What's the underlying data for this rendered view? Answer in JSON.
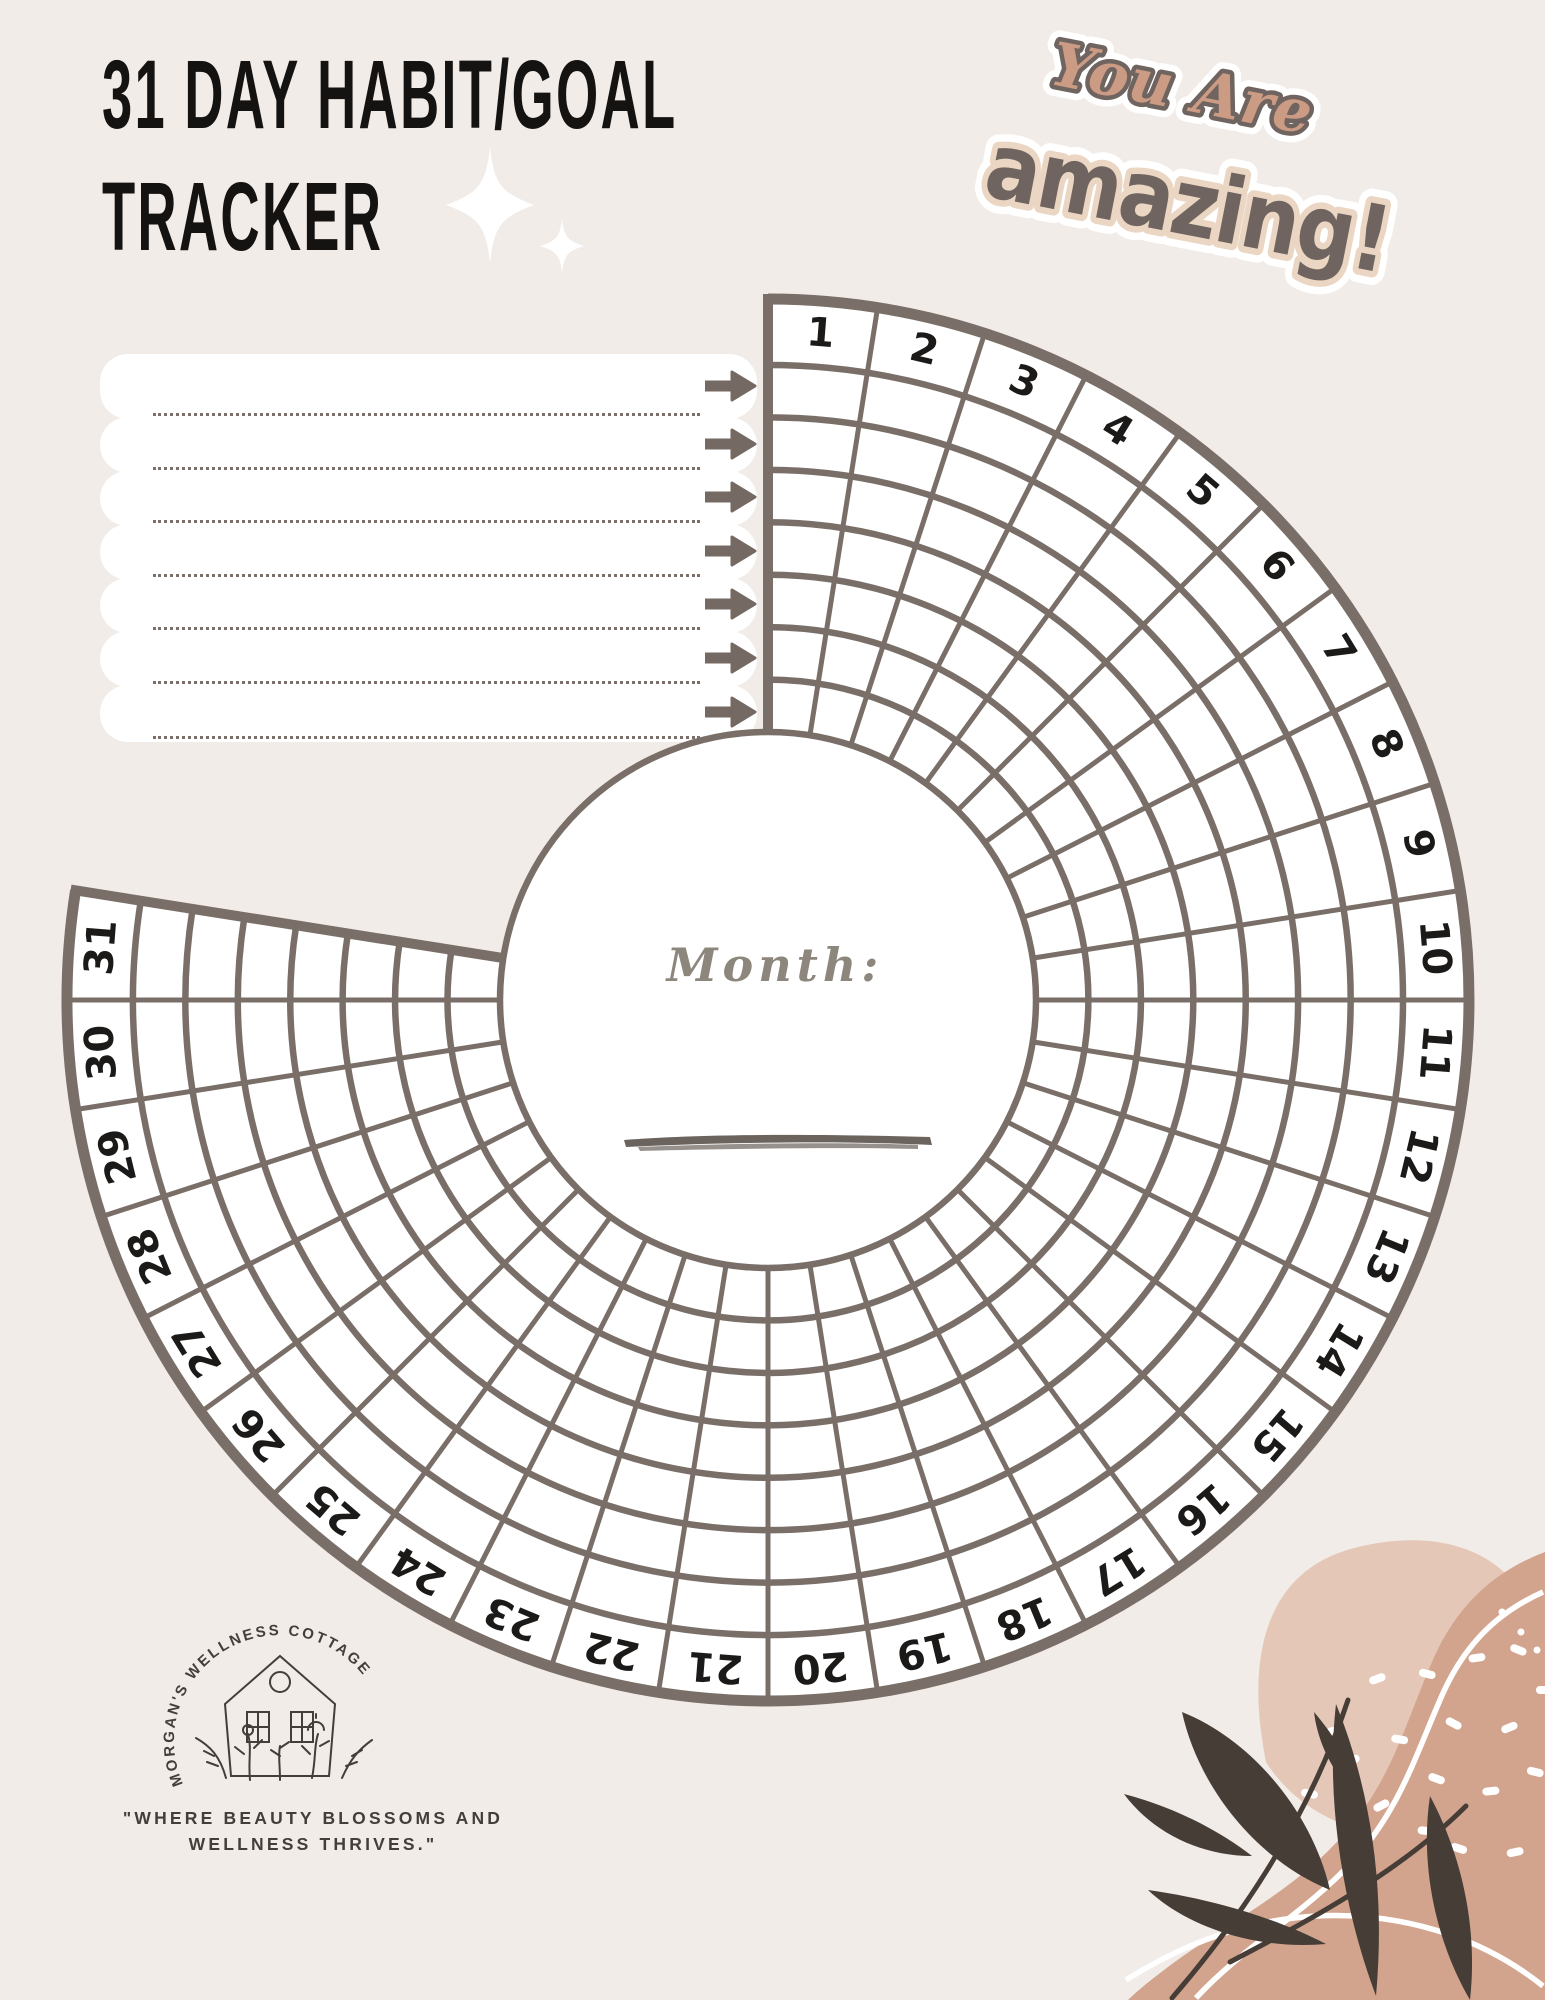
{
  "page": {
    "title_line1": "31 DAY HABIT/GOAL",
    "title_line2": "TRACKER"
  },
  "sticker": {
    "line1": "You Are",
    "line2": "amazing!"
  },
  "habit_box": {
    "lines": [
      "",
      "",
      "",
      "",
      "",
      "",
      ""
    ]
  },
  "tracker": {
    "month_label": "Month:",
    "month_value": "",
    "rings_per_day": 7,
    "days": [
      "1",
      "2",
      "3",
      "4",
      "5",
      "6",
      "7",
      "8",
      "9",
      "10",
      "11",
      "12",
      "13",
      "14",
      "15",
      "16",
      "17",
      "18",
      "19",
      "20",
      "21",
      "22",
      "23",
      "24",
      "25",
      "26",
      "27",
      "28",
      "29",
      "30",
      "31"
    ]
  },
  "logo": {
    "arc_text": "MORGAN'S WELLNESS COTTAGE",
    "tagline_line1": "\"WHERE BEAUTY BLOSSOMS AND",
    "tagline_line2": "WELLNESS THRIVES.\""
  },
  "colors": {
    "background": "#f2ece8",
    "grid": "#7a6f68",
    "ink": "#1c1a18",
    "arrow": "#746963",
    "dotted": "#7b7069",
    "month_text": "#8c867c",
    "underline": "#6b635d",
    "title": "#141312",
    "logo_ink": "#443e39",
    "sticker_script": "#cb9b84",
    "sticker_dark": "#6f6460",
    "sticker_cream": "#ead6c2",
    "blob_light": "#e4c7b6",
    "blob_dark": "#d2a48e",
    "leaf": "#473d37",
    "sparkle": "#ffffff"
  }
}
